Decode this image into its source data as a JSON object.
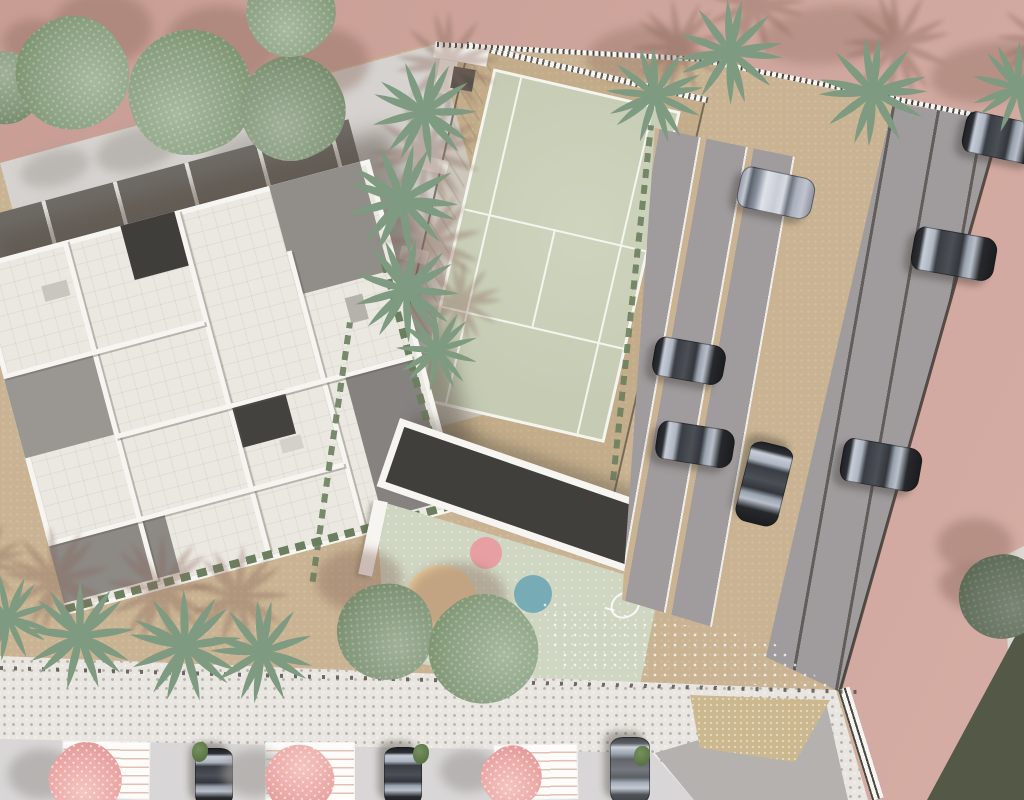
{
  "scene": {
    "description": "Aerial top-down architectural site plan render of a residential complex",
    "elements": [
      "apartment-building-roof",
      "padel-tennis-court",
      "parking-lot",
      "playground",
      "sidewalk",
      "street-parking",
      "palm-trees",
      "deciduous-trees",
      "pink-flowering-trees",
      "cars",
      "pergola-roof"
    ]
  },
  "colors": {
    "pink1": "#c79d94",
    "pink2": "#cfa69d",
    "pink3": "#d5ada4",
    "tan": "#c9b392",
    "tan2": "#ccb88f",
    "plaza": "#d5d2cf",
    "walk": "#e9e6e1",
    "walkdot": "#bab5ae",
    "street": "#d8d6d6",
    "gray2": "#b4b1ae",
    "dotrow": "#57524b",
    "court": "#c6ccb4",
    "court2": "#ced4bd",
    "cline": "#f5f5ef",
    "play": "#cfd6c2",
    "slab": "#413f3c",
    "white": "#f6f5f1",
    "roof": "#ebe8e1",
    "band": "#6f6b66",
    "terr1": "#918d89",
    "terr2": "#868280",
    "terr3": "#9a9691",
    "courtyard": "#403e3b",
    "strip": "#a09b9d",
    "sline": "#efede8",
    "sdark": "#615d5a",
    "hedge": "#6b7f5e",
    "tree": "#8ca283",
    "treehi": "#a8baa0",
    "treelo": "#70875f",
    "pinktree": "#eba9a6",
    "pinkhi": "#f4c5c1",
    "pinklo": "#d98f90",
    "palm": "#7e9a80",
    "palmshadow": "#8a685c",
    "plazashadow": "#a39e98",
    "grayshadow": "#a09d9a",
    "brownshadow": "#8a685c"
  },
  "features": {
    "round_trees": [
      {
        "x": 5,
        "y": 88,
        "r": 36,
        "tone": 1
      },
      {
        "x": 72,
        "y": 74,
        "r": 56,
        "tone": 0
      },
      {
        "x": 190,
        "y": 92,
        "r": 62,
        "tone": 0
      },
      {
        "x": 292,
        "y": 108,
        "r": 52,
        "tone": 1
      },
      {
        "x": 290,
        "y": 12,
        "r": 44,
        "tone": 0
      },
      {
        "x": 385,
        "y": 632,
        "r": 48,
        "tone": 1
      },
      {
        "x": 483,
        "y": 650,
        "r": 54,
        "tone": 0
      },
      {
        "x": 1001,
        "y": 597,
        "r": 42,
        "tone": 2
      }
    ],
    "palm_trees": [
      {
        "x": 424,
        "y": 112,
        "r": 56
      },
      {
        "x": 402,
        "y": 200,
        "r": 60
      },
      {
        "x": 406,
        "y": 290,
        "r": 56
      },
      {
        "x": 437,
        "y": 350,
        "r": 44
      },
      {
        "x": 655,
        "y": 95,
        "r": 52
      },
      {
        "x": 730,
        "y": 52,
        "r": 56
      },
      {
        "x": 873,
        "y": 92,
        "r": 58
      },
      {
        "x": 1018,
        "y": 88,
        "r": 50
      },
      {
        "x": 8,
        "y": 618,
        "r": 46
      },
      {
        "x": 80,
        "y": 636,
        "r": 58
      },
      {
        "x": 185,
        "y": 646,
        "r": 60
      },
      {
        "x": 262,
        "y": 652,
        "r": 55
      }
    ],
    "pink_trees": [
      {
        "x": 86,
        "y": 780,
        "r": 36
      },
      {
        "x": 299,
        "y": 779,
        "r": 34
      },
      {
        "x": 512,
        "y": 777,
        "r": 30
      }
    ],
    "green_tufts": [
      {
        "x": 200,
        "y": 752
      },
      {
        "x": 421,
        "y": 754
      },
      {
        "x": 642,
        "y": 756
      }
    ],
    "cars": [
      {
        "x": 775,
        "y": 192,
        "len": 74,
        "wid": 40,
        "rot": 12,
        "color": "silver"
      },
      {
        "x": 688,
        "y": 360,
        "len": 70,
        "wid": 38,
        "rot": 10,
        "color": "dark"
      },
      {
        "x": 694,
        "y": 443,
        "len": 76,
        "wid": 37,
        "rot": 9,
        "color": "dark"
      },
      {
        "x": 880,
        "y": 464,
        "len": 78,
        "wid": 42,
        "rot": 10,
        "color": "dark"
      },
      {
        "x": 1001,
        "y": 137,
        "len": 76,
        "wid": 40,
        "rot": 12,
        "color": "dark"
      },
      {
        "x": 953,
        "y": 253,
        "len": 82,
        "wid": 42,
        "rot": 10,
        "color": "dark"
      },
      {
        "x": 763,
        "y": 483,
        "len": 80,
        "wid": 42,
        "rot": 104,
        "color": "dark"
      },
      {
        "x": 213,
        "y": 777,
        "len": 58,
        "wid": 36,
        "rot": 90,
        "color": "dark"
      },
      {
        "x": 402,
        "y": 776,
        "len": 58,
        "wid": 36,
        "rot": 90,
        "color": "dark"
      },
      {
        "x": 629,
        "y": 770,
        "len": 66,
        "wid": 38,
        "rot": 90,
        "color": "gray"
      }
    ],
    "playground_circles": [
      {
        "x": 441,
        "y": 601,
        "r": 36,
        "color": "#e9cd9c"
      },
      {
        "x": 486,
        "y": 553,
        "r": 16,
        "color": "#e79fa4"
      },
      {
        "x": 533,
        "y": 594,
        "r": 19,
        "color": "#77acb6"
      }
    ],
    "street_stalls": [
      {
        "x": 62,
        "y": 741,
        "w": 86,
        "h": 56,
        "rot": 1
      },
      {
        "x": 265,
        "y": 742,
        "w": 88,
        "h": 57,
        "rot": 0
      },
      {
        "x": 494,
        "y": 744,
        "w": 82,
        "h": 54,
        "rot": -1
      }
    ],
    "shadow_blobs": [
      {
        "x": 95,
        "y": 128,
        "w": 85,
        "h": 42,
        "rot": -15,
        "c": "plazashadow",
        "o": 0.55
      },
      {
        "x": 205,
        "y": 132,
        "w": 95,
        "h": 46,
        "rot": -15,
        "c": "plazashadow",
        "o": 0.5
      },
      {
        "x": 20,
        "y": 150,
        "w": 70,
        "h": 36,
        "rot": -15,
        "c": "plazashadow",
        "o": 0.5
      },
      {
        "x": 318,
        "y": 212,
        "w": 95,
        "h": 62,
        "rot": -18,
        "c": "plazashadow",
        "o": 0.45
      },
      {
        "x": 585,
        "y": 26,
        "w": 110,
        "h": 55,
        "rot": -8,
        "c": "brownshadow",
        "o": 0.35
      },
      {
        "x": 760,
        "y": 6,
        "w": 140,
        "h": 58,
        "rot": -6,
        "c": "brownshadow",
        "o": 0.33
      },
      {
        "x": 930,
        "y": 42,
        "w": 120,
        "h": 60,
        "rot": -8,
        "c": "brownshadow",
        "o": 0.38
      },
      {
        "x": 938,
        "y": 566,
        "w": 90,
        "h": 48,
        "rot": 12,
        "c": "brownshadow",
        "o": 0.45
      }
    ]
  }
}
